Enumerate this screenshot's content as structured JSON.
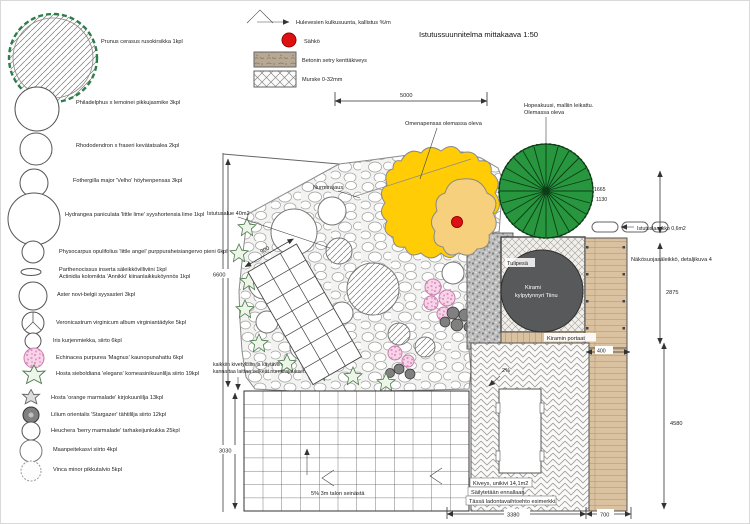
{
  "title": "Istutussuunnitelma mittakaava 1:50",
  "legend": {
    "flow_label": "Hulevesien kulkusuunta, kallistus %/m",
    "electric_label": "Sähkö",
    "paving_label": "Betonin setry kenttäkiveys",
    "gravel_label": "Murske 0-32mm"
  },
  "plants": [
    "Prunus cerasus rusokirsikka 1kpl",
    "Philadelphus x lemoinei pikkujasmike 3kpl",
    "Rhododendron x fraseri kevätatsalea 2kpl",
    "Fothergilla major 'Velho' höyhenpensas 3kpl",
    "Hydrangea paniculata 'little lime' syyshortensia lime 1kpl",
    "Physocarpus opulifolius 'little angel' purppuraheisiangervo pieni 6kpl",
    "Parthenocissus inserta säleikkövilliviini 1kpl",
    "Actinidia kolomikta 'Annikki' kiinanlaikkuköynnös 1kpl",
    "Aster novi-belgii syysasteri 3kpl",
    "Veronicastrum virginicum album virginiantädyke 5kpl",
    "Iris kurjenmiekka, siirto 6kpl",
    "Echinacea purpurea 'Magnus' kaunopunahattu 6kpl",
    "Hosta sieboldiana 'elegans' komeasinikuunlilja siirto 19kpl",
    "Hosta 'orange marmalade' kirjokuunlilja 13kpl",
    "Lilium orientalis 'Stargazer' tähtililja siirto 12kpl",
    "Heuchera 'berry marmalade' tarhakeijunkukka 25kpl",
    "Maanpeitekasvi siirto 4kpl",
    "Vinca minor pikkutalvio 5kpl"
  ],
  "plan": {
    "labels": {
      "apple": "Omenapensas olemassa oleva",
      "spruce1": "Hopeakuusi, malliin leikattu.",
      "spruce2": "Olemassa oleva",
      "lawn_edge": "Nurmirajaus",
      "bed_area": "Istutusalue 40m2",
      "planter": "Istutuslaatikko 0,6m2",
      "screen": "Näkösuojasäleikkö, detaljikuva 4",
      "firepit": "Tulipesä",
      "tub1": "Kirami",
      "tub2": "kylpytynnyri Tiinu",
      "stairs": "Kiramin portaat",
      "note1": "kaikkiin kivetyksiin ja käytäviin",
      "note2": "kannattaa laittaa selkeät nurmirajaukset.",
      "slope_house": "5% 3m talon seinästä",
      "slope2": "2%",
      "paving1": "Kiveys, unikivi 14,1m2",
      "paving2": "Säilytetään ennallaan.",
      "paving3": "Tässä ladontavaihtoehto esimerkki."
    },
    "dims": {
      "top": "5000",
      "left": "6600",
      "left2": "3030",
      "right1": "1665",
      "right2": "1130",
      "right3": "2875",
      "right4": "4580",
      "step": "400",
      "bottom1": "3380",
      "bottom2": "700",
      "path": "900"
    }
  }
}
